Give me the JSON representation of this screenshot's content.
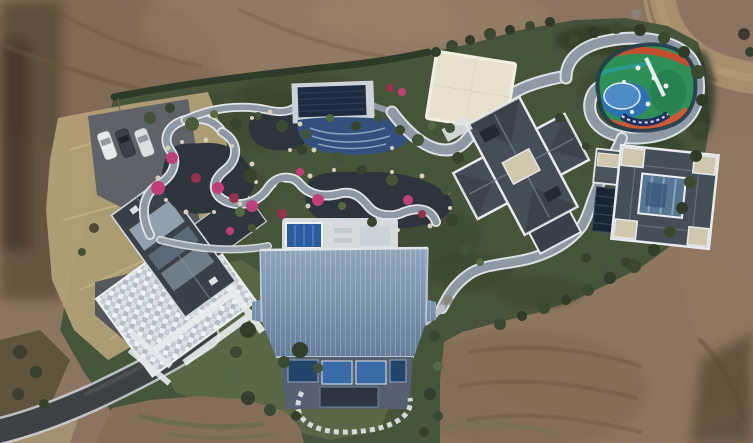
{
  "scene": {
    "type": "aerial-drone-photo",
    "subject": "luxury estate compound with landscaped garden, koi pond, covered pool, playground, four buildings and a large blue-roofed barn, surrounded by graded bare earth",
    "vehicles_visible": 3,
    "buildings_visible": 5
  },
  "palette": {
    "dirt_base": "#8c7560",
    "dirt_dark": "#6c5640",
    "dirt_darker": "#4a3a2a",
    "dirt_light": "#a3896a",
    "dirt_shadow": "#3a2d20",
    "dirt_road": "#a78e6d",
    "dry_grass": "#b2a077",
    "garden_green": "#46543a",
    "garden_dark": "#3a472f",
    "lawn_green": "#5c6847",
    "hedge_dark": "#2c3a27",
    "shrub_dark": "#374430",
    "shrub_mid": "#4a5a38",
    "shrub_light": "#6d7c50",
    "pond_water": "#2d343c",
    "rock_tan": "#d7cfba",
    "azalea_pink": "#bf3f79",
    "azalea_deep": "#97304f",
    "path_gray": "#8e99a4",
    "path_edge": "#e2e6e9",
    "stepstone": "#b9c1c9",
    "road_asphalt": "#3e4144",
    "road_edge": "#cdd1d5",
    "parking_gray": "#5f6266",
    "driveway_gray": "#54575b",
    "car_white": "#e8eaec",
    "car_dark": "#3c4046",
    "patio_base": "#c6cbd1",
    "patio_white": "#eef0f3",
    "roof_dark": "#454d56",
    "roof_trim": "#e8ebee",
    "roof_ridge": "#7b848e",
    "roof_beige": "#cfc7ae",
    "skylight_dark": "#222930",
    "atrium_glass": "#567693",
    "solar_dark": "#1a2532",
    "left_roof": "#3a4047",
    "left_roof_glass": "#9cabb8",
    "barn_wall": "#566070",
    "barn_trim": "#dfe5ea",
    "barn_window_dark": "#24456b",
    "barn_window_blue": "#3a6ba6",
    "pool_cover_navy": "#1e2a40",
    "pool_deck_blue": "#33507c",
    "pool_wave": "#93abc9",
    "plunge_pool_blue": "#2a5c9e",
    "pool_pad": "#ccd2d7",
    "pavilion_cream": "#e8e1ce",
    "pavilion_trim": "#f2eee0",
    "playground_border": "#203c4a",
    "playground_green": "#2e8f57",
    "playground_blue": "#2f72b4",
    "playground_orange": "#cd5a36",
    "playground_red": "#c14f30",
    "playground_teal": "#2a9a8f",
    "playground_white": "#eef1f3"
  }
}
